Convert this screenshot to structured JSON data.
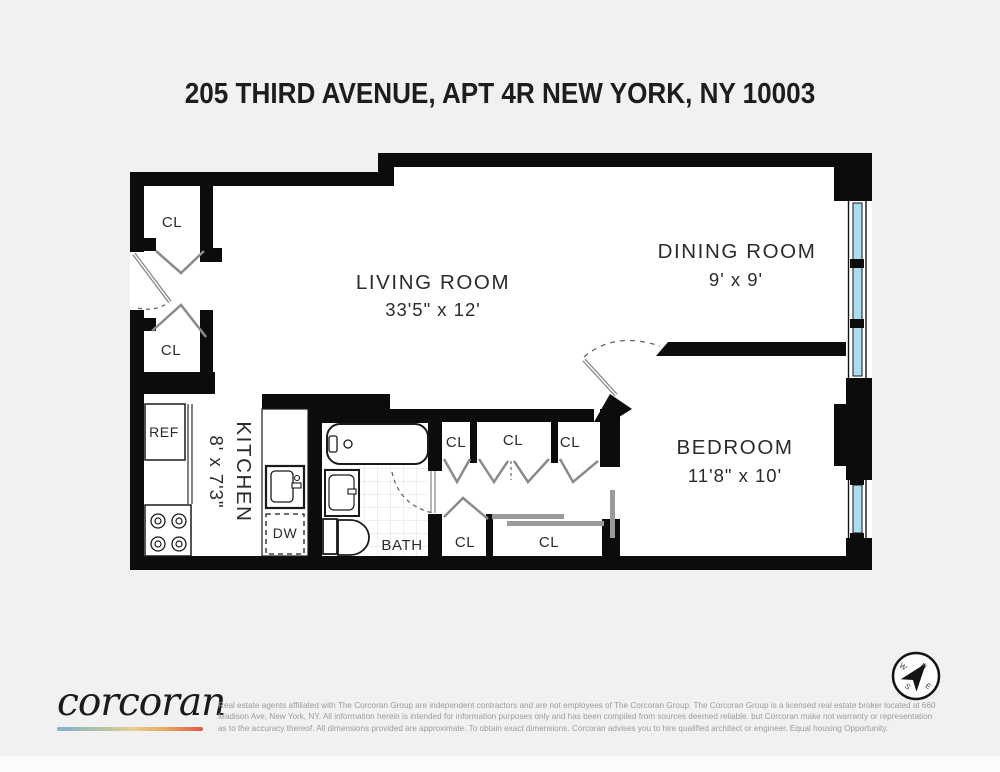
{
  "title": "205 THIRD AVENUE, APT 4R NEW YORK, NY 10003",
  "rooms": {
    "living": {
      "name": "LIVING ROOM",
      "dims": "33'5\" x 12'"
    },
    "dining": {
      "name": "DINING ROOM",
      "dims": "9' x 9'"
    },
    "bedroom": {
      "name": "BEDROOM",
      "dims": "11'8\" x 10'"
    },
    "kitchen": {
      "name": "KITCHEN",
      "dims": "8' x 7'3\""
    },
    "bath": {
      "name": "BATH"
    }
  },
  "fixtures": {
    "closet": "CL",
    "refrigerator": "REF",
    "dishwasher": "DW"
  },
  "compass": {
    "north": "N",
    "east": "E",
    "south": "S",
    "west": "W"
  },
  "footer": {
    "brand": "corcoran",
    "disclaimer": [
      "Real estate agents affiliated with The Corcoran Group are independent contractors and are not employees of The Corcoran Group. The Corcoran Group is a licensed real estate broker located at 660",
      "Madison Ave, New York, NY. All information herein is intended for information purposes only and has been compiled from sources deemed reliable. but Corcoran make not warranty or representation",
      "as to the accuracy thereof. All dimensions provided are approximate. To obtain exact dimensions. Corcoran advises you to hire qualified architect or engineer. Equal housing Opportunity."
    ]
  },
  "colors": {
    "background": "#f1f1f1",
    "wall": "#0c0c0c",
    "window_glass": "#aadcf2",
    "door_swing": "#8b8b8b"
  }
}
